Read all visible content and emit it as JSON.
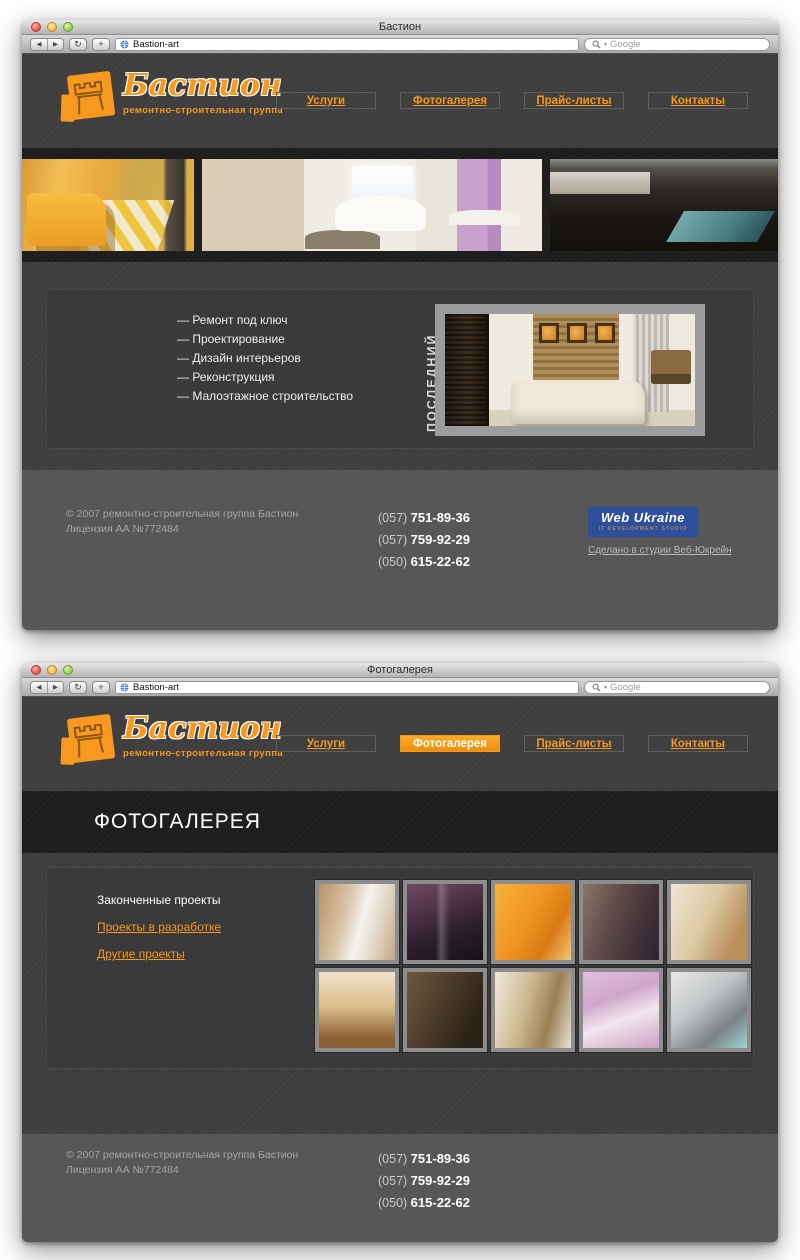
{
  "site": {
    "chrome": {
      "url": "Bastion-art",
      "search_placeholder": "Google",
      "icons": {
        "back": "◀",
        "forward": "▶",
        "reload": "↻",
        "add": "+",
        "search_chevron": "▾"
      }
    },
    "logo": {
      "text": "Бастион",
      "tagline": "ремонтно-строительная группа",
      "icon": "fortress-icon"
    },
    "nav": [
      {
        "label": "Услуги"
      },
      {
        "label": "Фотогалерея"
      },
      {
        "label": "Прайс-листы"
      },
      {
        "label": "Контакты"
      }
    ],
    "footer": {
      "copyright": "© 2007  ремонтно-строительная группа Бастион",
      "license": "Лицензия АА №772484",
      "phones": [
        {
          "code": "(057)",
          "number": "751-89-36"
        },
        {
          "code": "(057)",
          "number": "759-92-29"
        },
        {
          "code": "(050)",
          "number": "615-22-62"
        }
      ],
      "studio": {
        "logo_text": "Web Ukraine",
        "logo_sub": "IT DEVELOPMENT STUDIO",
        "link": "Сделано в студии Веб-Юкрейн"
      }
    },
    "colors": {
      "accent_orange": "#F6991E",
      "page_bg": "#3E3E3E",
      "band_bg": "#1D1D1D",
      "panel_bg": "#3A3A3A",
      "footer_bg": "#575757",
      "studio_blue": "#2E4F9E"
    }
  },
  "window_home": {
    "chrome": {
      "title": "Бастион"
    },
    "services": {
      "items": [
        "— Ремонт под ключ",
        "— Проектирование",
        "— Дизайн интерьеров",
        "— Реконструкция",
        "— Малоэтажное строительство"
      ]
    },
    "latest_project_label": "ПОСЛЕДНИЙ ПРОЕКТ",
    "strip_photos": [
      {
        "label": "orange-living-room-photo"
      },
      {
        "label": "white-sofa-living-room-photo"
      },
      {
        "label": "dark-kitchen-photo"
      }
    ],
    "project_photo_label": "latest-project-interior-photo"
  },
  "window_gallery": {
    "chrome": {
      "title": "Фотогалерея"
    },
    "heading": "ФОТОГАЛЕРЕЯ",
    "sections": {
      "current": "Законченные проекты",
      "links": [
        {
          "label": "Проекты в разработке"
        },
        {
          "label": "Другие проекты"
        }
      ]
    },
    "thumbs": [
      {
        "label": "beige-living-room-thumb"
      },
      {
        "label": "purple-kitchen-thumb"
      },
      {
        "label": "orange-interior-thumb"
      },
      {
        "label": "brown-living-room-thumb"
      },
      {
        "label": "wooden-dining-room-thumb"
      },
      {
        "label": "beige-bar-interior-thumb"
      },
      {
        "label": "stone-wall-living-room-thumb"
      },
      {
        "label": "cream-sofa-interior-thumb"
      },
      {
        "label": "pink-bedroom-thumb"
      },
      {
        "label": "white-kitchen-thumb"
      }
    ]
  }
}
